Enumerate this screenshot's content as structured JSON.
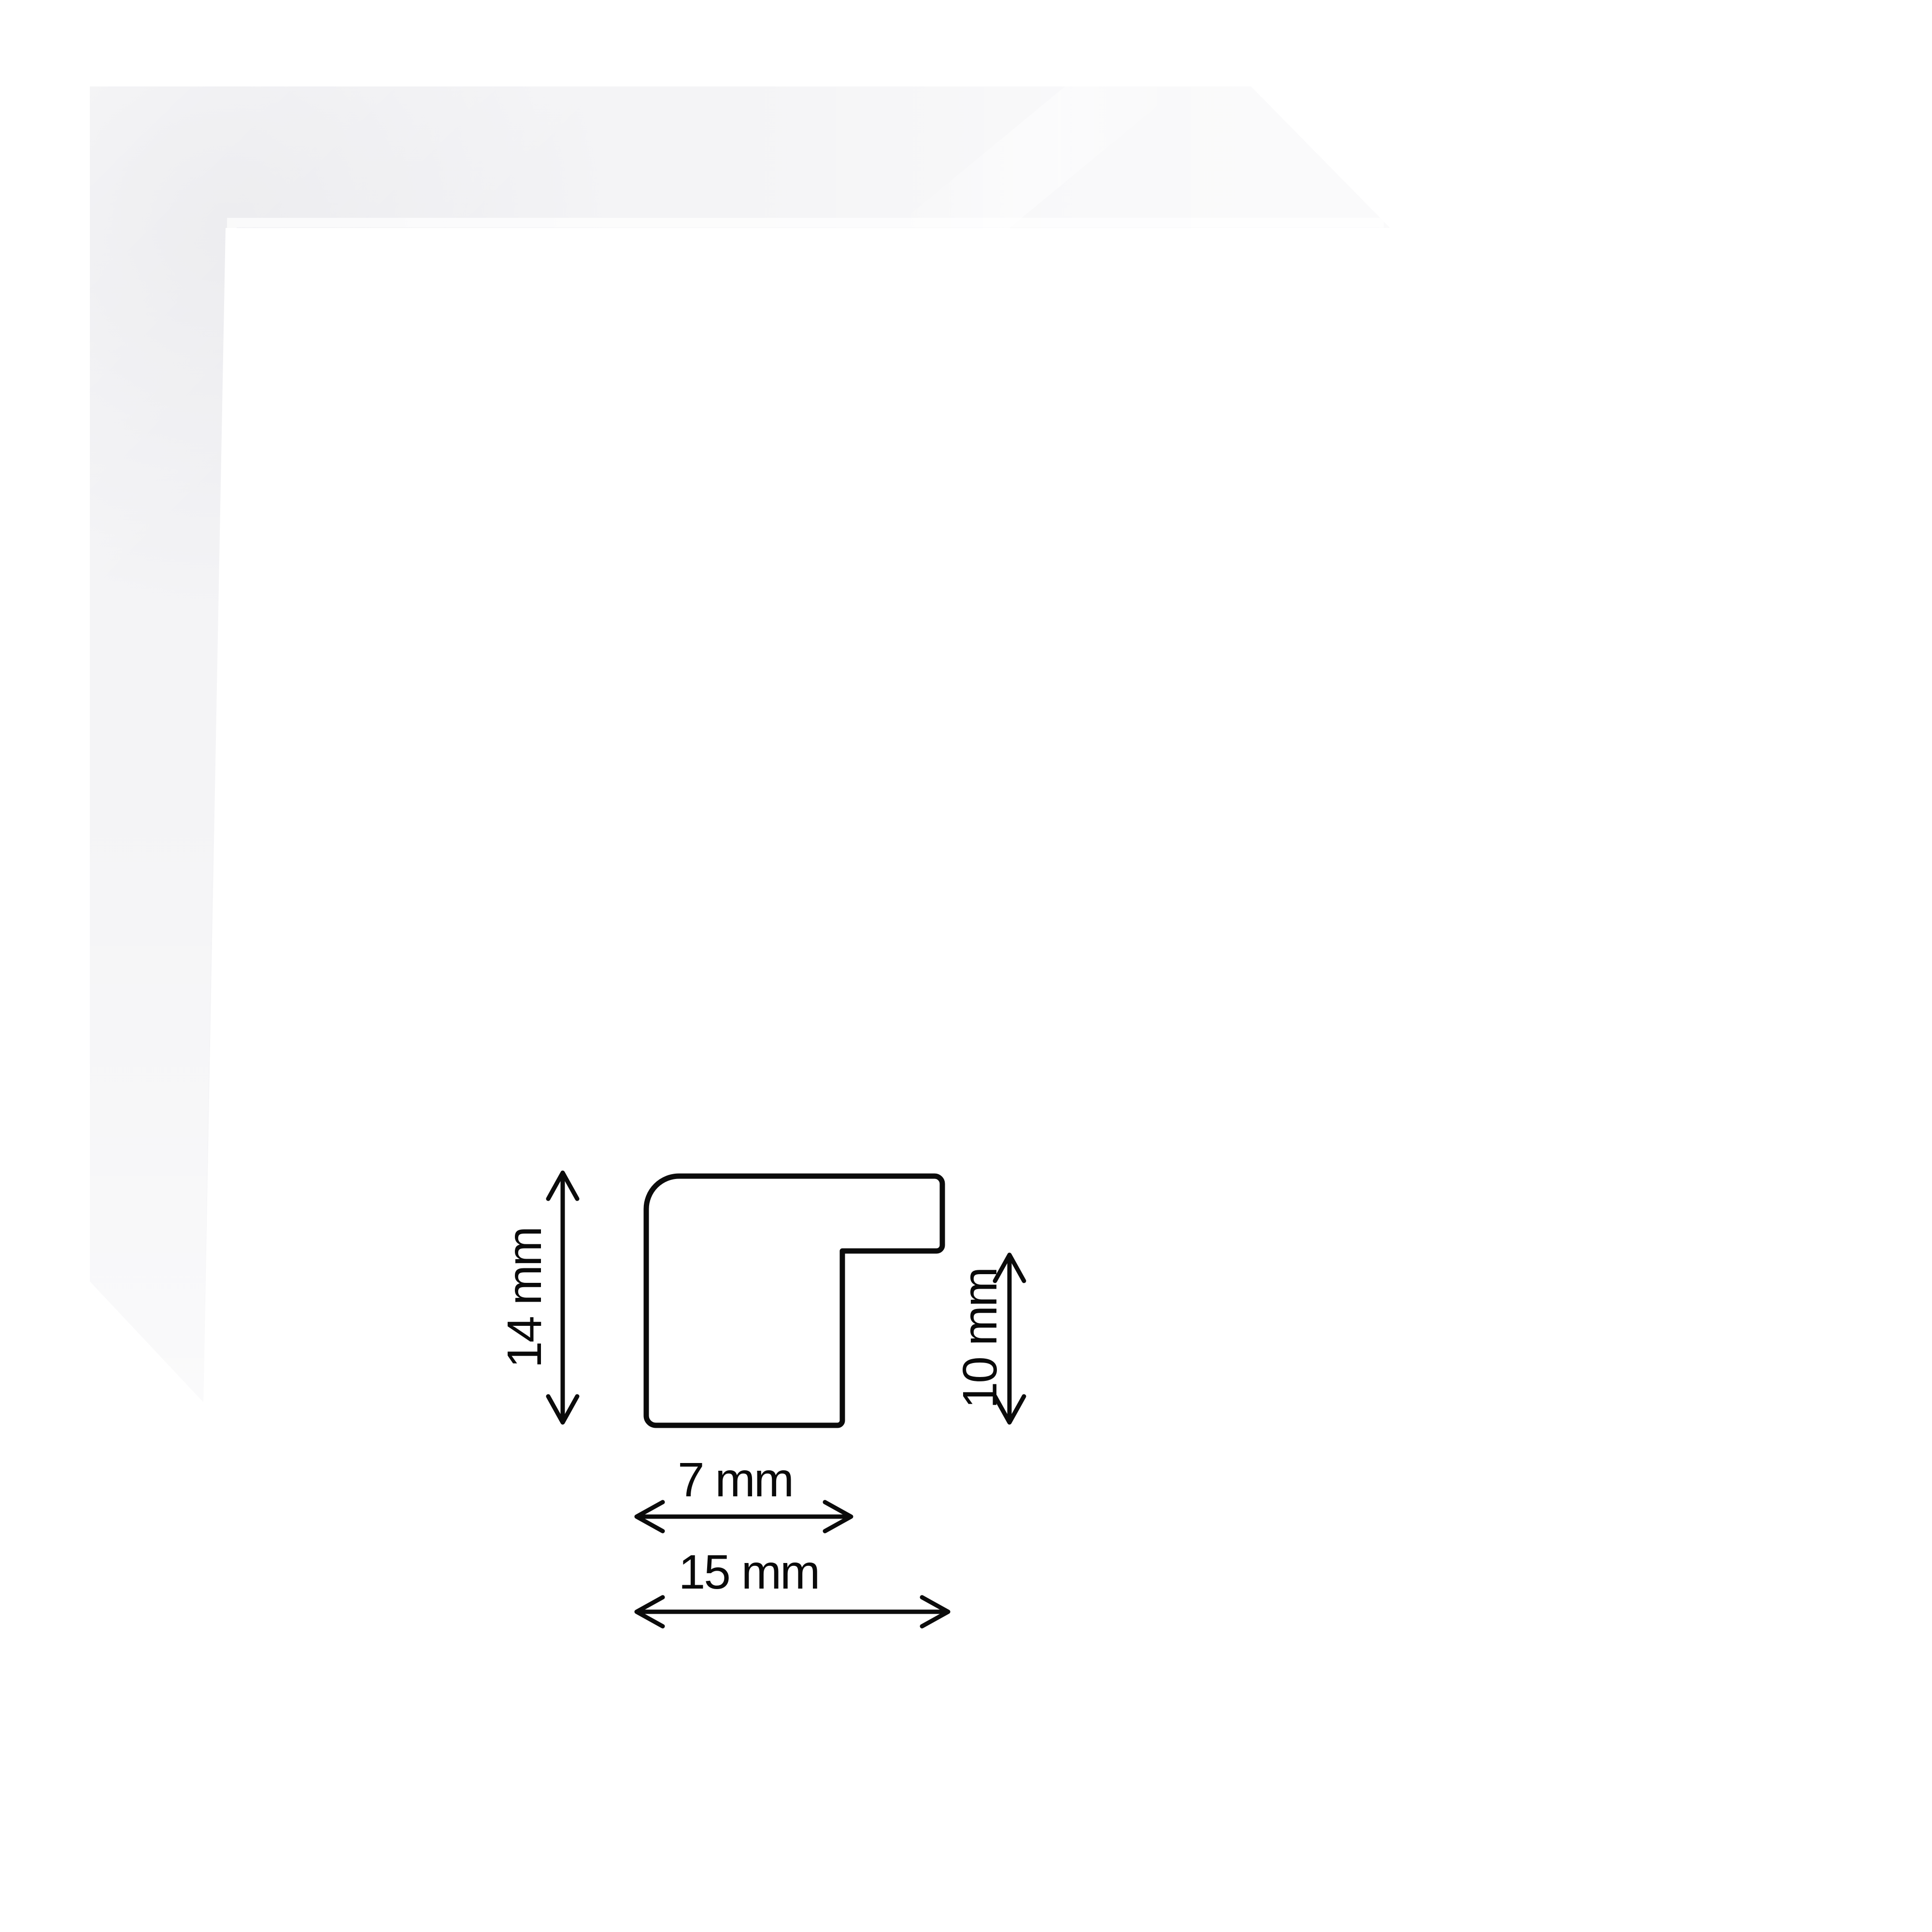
{
  "page": {
    "background_color": "#ffffff"
  },
  "product_photo": {
    "name": "white picture frame corner sample",
    "frame_color": "#f4f4f6",
    "highlight_color": "#fbfbfd"
  },
  "diagram": {
    "outline_color": "#0b0b0b",
    "dimensions": {
      "height": {
        "label": "14 mm"
      },
      "rabbet_height": {
        "label": "10 mm"
      },
      "face_width": {
        "label": "7 mm"
      },
      "total_width": {
        "label": "15 mm"
      }
    }
  }
}
